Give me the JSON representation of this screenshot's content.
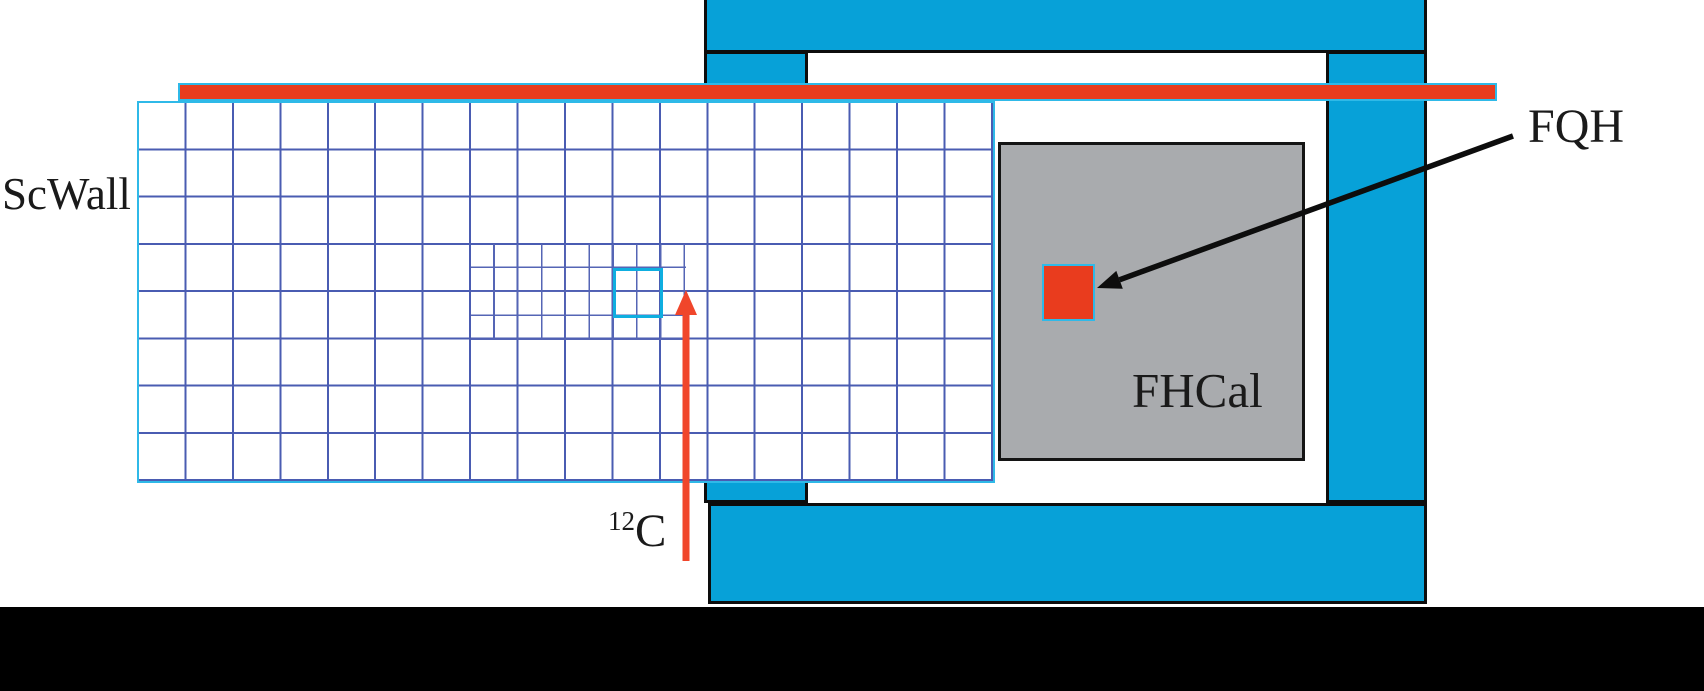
{
  "figure": {
    "type": "experimental-setup-diagram",
    "labels": {
      "scwall": "ScWall",
      "fhcal": "FHCal",
      "fqh": "FQH",
      "beam_mass_number": "12",
      "beam_element": "C"
    },
    "colors": {
      "stand_blue": "#07A1D8",
      "beam_red": "#E93C1E",
      "beam_arrow_red": "#F0462B",
      "grid_line_blue": "#4A5CB2",
      "fine_grid_line_blue": "#5565B5",
      "cyan_edge": "#2FB9E8",
      "highlight_cyan": "#0FAEE0",
      "fhcal_gray": "#A9ABAE",
      "floor_black": "#000000",
      "text_black": "#1A1A1A"
    }
  }
}
